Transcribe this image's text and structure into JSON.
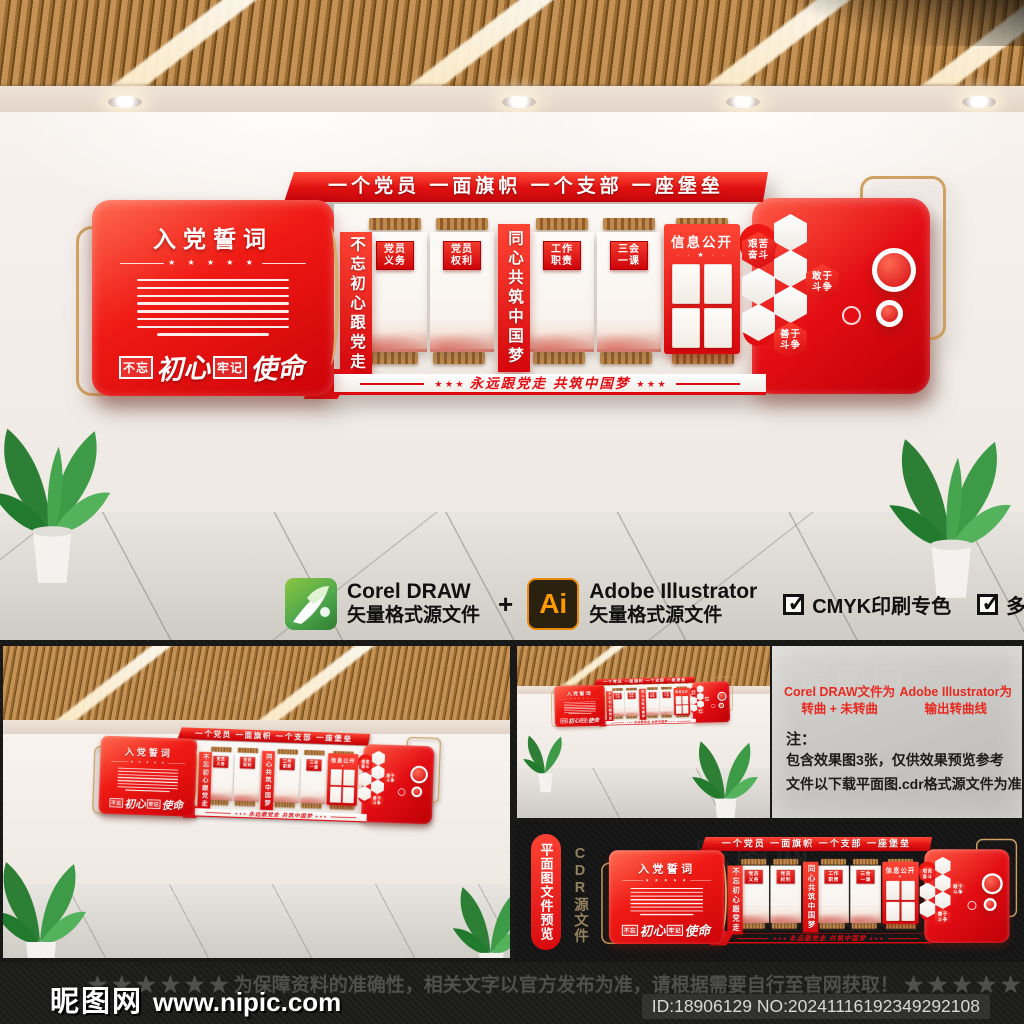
{
  "wall": {
    "header": "一个党员  一面旗帜  一个支部  一座堡垒",
    "oath": {
      "title": "入党誓词",
      "stars": "★ ★ ★ ★ ★",
      "motto_box1": "不忘",
      "motto_script1": "初心",
      "motto_box2": "牢记",
      "motto_script2": "使命"
    },
    "left_banner": "不忘初心跟党走",
    "center_banner": "同心共筑中国梦",
    "panels": [
      {
        "l1": "党员",
        "l2": "义务"
      },
      {
        "l1": "党员",
        "l2": "权利"
      },
      {
        "l1": "工作",
        "l2": "职责"
      },
      {
        "l1": "三会",
        "l2": "一课"
      }
    ],
    "info": {
      "title": "信息公开",
      "dots": "· · ★ · ·"
    },
    "hexagons": [
      {
        "l1": "艰苦",
        "l2": "奋斗"
      },
      {
        "l1": "敢于",
        "l2": "斗争"
      },
      {
        "l1": "善于",
        "l2": "斗争"
      }
    ],
    "slogan": {
      "stars": "★ ★ ★",
      "text": "永远跟党走  共筑中国梦"
    }
  },
  "software": {
    "corel": {
      "name": "Corel DRAW",
      "desc": "矢量格式源文件"
    },
    "plus": "+",
    "ai": {
      "badge": "Ai",
      "name": "Adobe Illustrator",
      "desc": "矢量格式源文件"
    },
    "check_glyph": "✓",
    "checks": [
      "CMYK印刷专色",
      "多方位高清效果图"
    ]
  },
  "notes": {
    "corel_line1": "Corel DRAW文件为",
    "corel_line2": "转曲 + 未转曲",
    "ai_line1": "Adobe Illustrator为",
    "ai_line2": "输出转曲线",
    "label": "注：",
    "line1": "包含效果图3张，仅供效果预览参考",
    "line2": "文件以下载平面图.cdr格式源文件为准"
  },
  "flat": {
    "label": "平面图文件预览",
    "sublabel": "CDR源文件"
  },
  "footer": {
    "site": "昵图网",
    "url": "www.nipic.com",
    "stars_left": "★ ★ ★ ★ ★ ★ ",
    "disclaimer": "为保障资料的准确性，相关文字以官方发布为准，请根据需要自行至官网获取！",
    "stars_right": " ★ ★ ★ ★ ★",
    "id": "ID:18906129 NO:20241116192349292108"
  },
  "watermark": "昵图网",
  "colors": {
    "red": "#e30d13",
    "gold": "#cfa263",
    "green": "#4ea84c",
    "orange": "#ff9a00"
  }
}
